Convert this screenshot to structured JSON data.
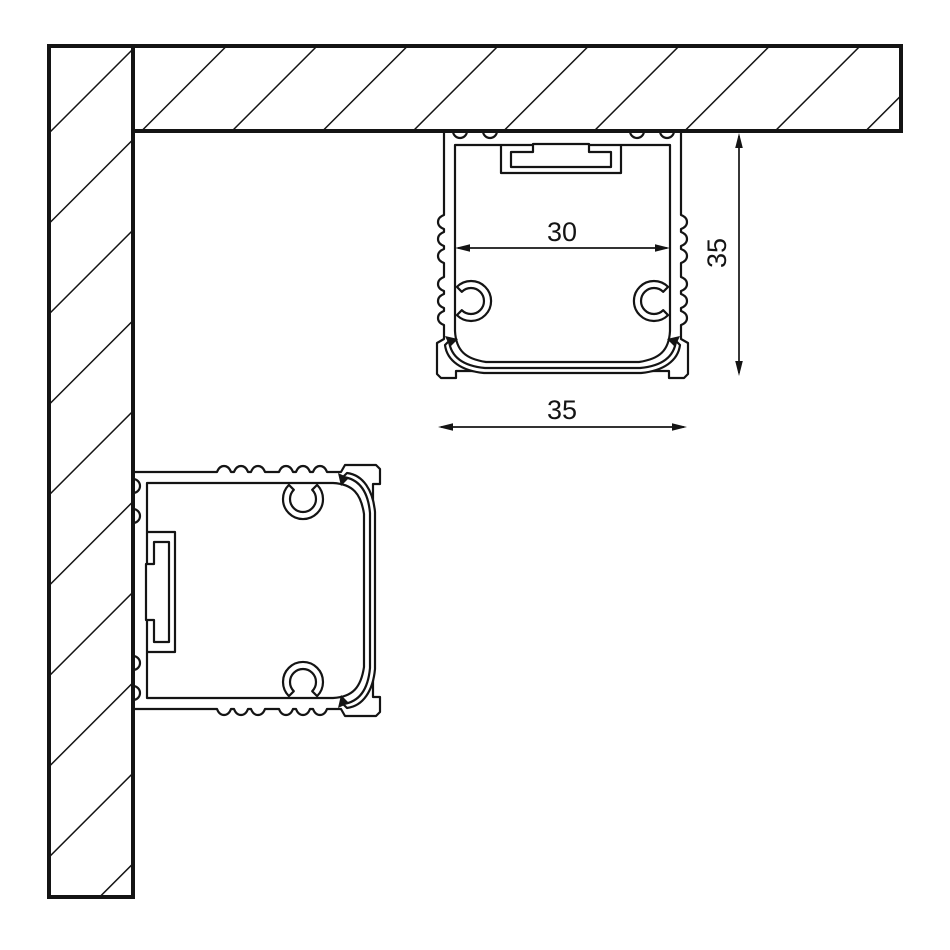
{
  "diagram": {
    "subject": "aluminium-profile-mounting-cross-section",
    "background_color": "#ffffff",
    "line_color": "#141414",
    "dimensions": {
      "inner_width": {
        "label": "30"
      },
      "profile_height": {
        "label": "35"
      },
      "profile_width": {
        "label": "35"
      }
    },
    "surfaces": {
      "ceiling": "hatched-ceiling-section",
      "wall": "hatched-wall-section"
    }
  }
}
